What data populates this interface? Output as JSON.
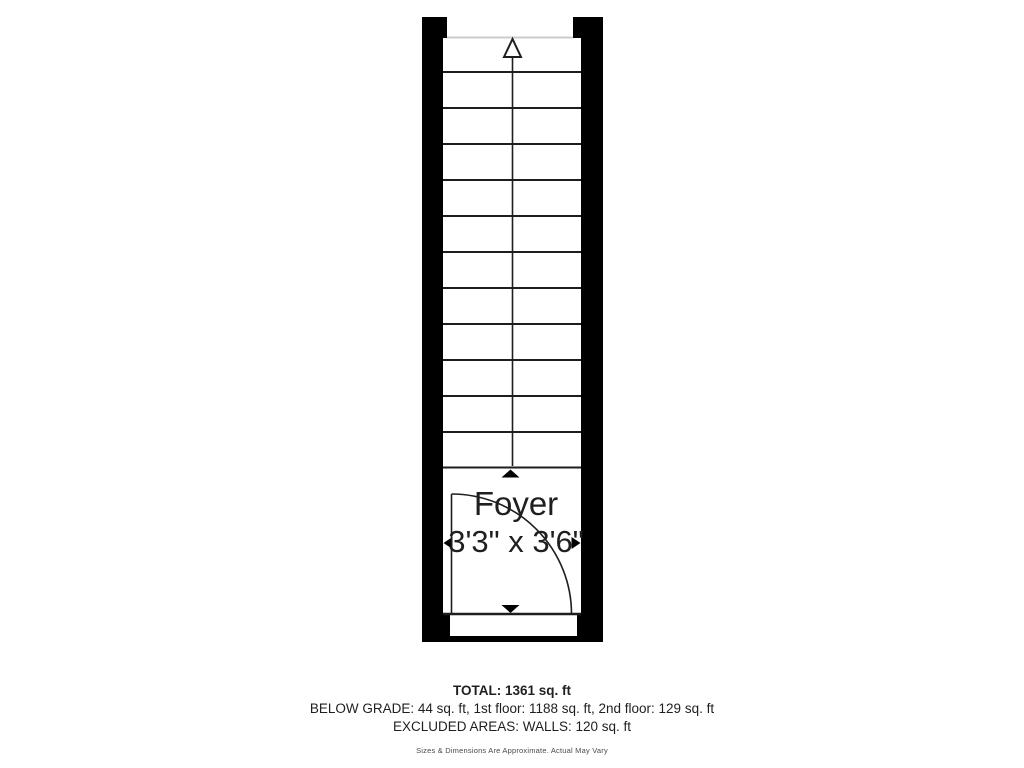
{
  "floorplan": {
    "room": {
      "name": "Foyer",
      "dimensions": "3'3\" x 3'6\""
    },
    "stairs": {
      "tread_count": 12,
      "direction": "up"
    },
    "icons": {
      "stair_direction": "up-arrow",
      "extent_markers": "up-triangle, down-triangle, left-triangle, right-triangle",
      "door": "quarter-circle-swing-arc"
    },
    "colors": {
      "wall": "#000000",
      "line": "#1e1e1e",
      "cut_line": "#cccccc",
      "background": "#ffffff",
      "text": "#1f1f1f"
    }
  },
  "summary": {
    "total": "TOTAL: 1361 sq. ft",
    "breakdown": "BELOW GRADE: 44 sq. ft, 1st floor: 1188 sq. ft, 2nd floor: 129 sq. ft",
    "excluded": "EXCLUDED AREAS: WALLS: 120 sq. ft",
    "disclaimer": "Sizes & Dimensions Are Approximate. Actual May Vary"
  }
}
